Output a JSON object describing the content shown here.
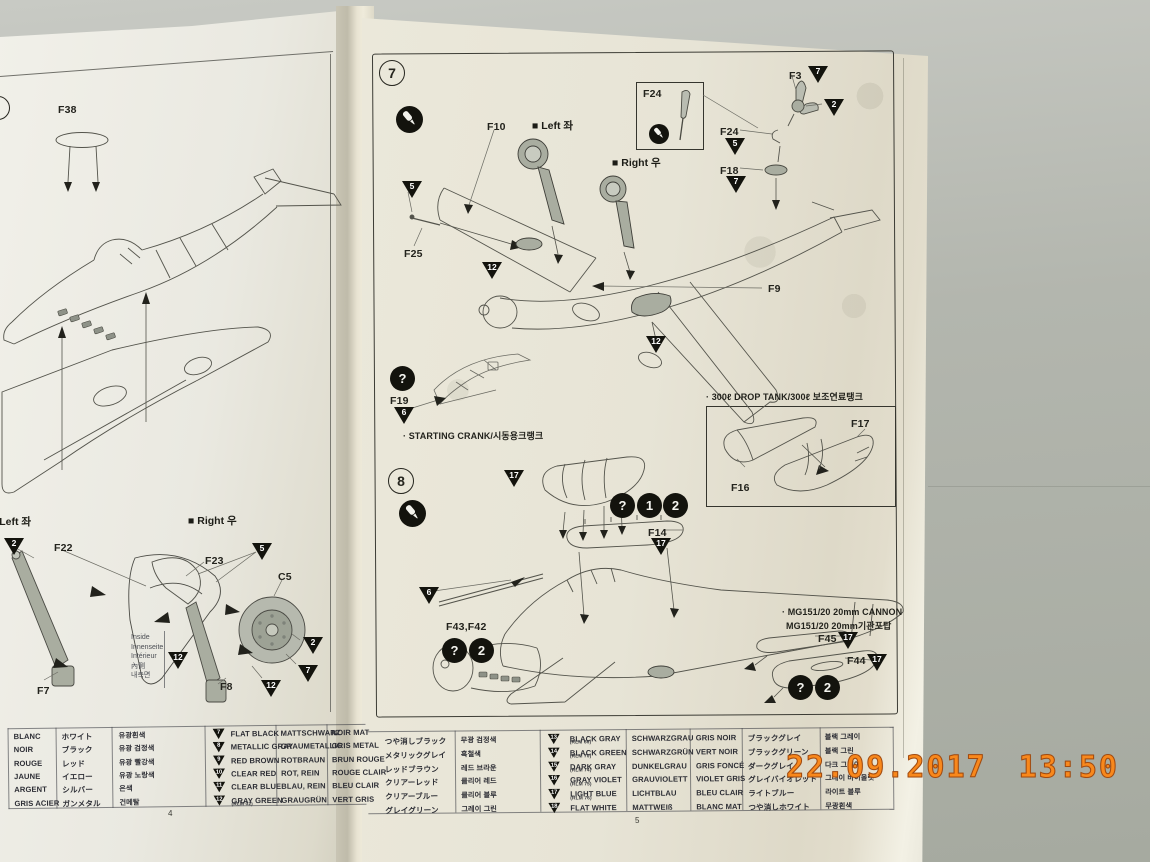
{
  "timestamp": "22.09.2017 13:50",
  "left_page": {
    "page_number": "4",
    "marker_left": "■ Left 좌",
    "marker_right": "■ Right 우",
    "inside": [
      "Inside",
      "Innenseite",
      "Intérieur",
      "內側",
      "내측면"
    ],
    "part_labels": [
      {
        "text": "F38",
        "x": 58,
        "y": 104
      },
      {
        "text": "F22",
        "x": 54,
        "y": 542
      },
      {
        "text": "F23",
        "x": 205,
        "y": 555
      },
      {
        "text": "C5",
        "x": 278,
        "y": 571
      },
      {
        "text": "F7",
        "x": 37,
        "y": 685
      },
      {
        "text": "F8",
        "x": 220,
        "y": 681
      }
    ],
    "triangles": [
      {
        "n": "2",
        "x": 4,
        "y": 538
      },
      {
        "n": "5",
        "x": 252,
        "y": 543
      },
      {
        "n": "12",
        "x": 168,
        "y": 652
      },
      {
        "n": "2",
        "x": 303,
        "y": 637
      },
      {
        "n": "7",
        "x": 298,
        "y": 665
      },
      {
        "n": "12",
        "x": 261,
        "y": 680
      }
    ]
  },
  "right_page": {
    "page_number": "5",
    "step7": {
      "number": "7",
      "marker_left": "■ Left 좌",
      "marker_right": "■ Right 우",
      "note_crank": "· STARTING CRANK/시동용크랭크",
      "note_drop_tank": "· 300ℓ DROP TANK/300ℓ 보조연료탱크"
    },
    "step8": {
      "number": "8",
      "note_cannon_en": "· MG151/20 20mm CANNON",
      "note_cannon_ko": "MG151/20 20mm기관포탑"
    },
    "part_labels": [
      {
        "text": "F10",
        "x": 487,
        "y": 121
      },
      {
        "text": "F24",
        "x": 643,
        "y": 88
      },
      {
        "text": "F24",
        "x": 720,
        "y": 126
      },
      {
        "text": "F3",
        "x": 789,
        "y": 70
      },
      {
        "text": "F18",
        "x": 720,
        "y": 165
      },
      {
        "text": "F25",
        "x": 404,
        "y": 248
      },
      {
        "text": "F9",
        "x": 768,
        "y": 283
      },
      {
        "text": "F19",
        "x": 390,
        "y": 395
      },
      {
        "text": "F17",
        "x": 851,
        "y": 418
      },
      {
        "text": "F16",
        "x": 731,
        "y": 482
      },
      {
        "text": "F14",
        "x": 648,
        "y": 527
      },
      {
        "text": "F43,F42",
        "x": 446,
        "y": 621
      },
      {
        "text": "F45",
        "x": 818,
        "y": 633
      },
      {
        "text": "F44",
        "x": 847,
        "y": 655
      }
    ],
    "triangles": [
      {
        "n": "5",
        "x": 402,
        "y": 181
      },
      {
        "n": "7",
        "x": 808,
        "y": 66
      },
      {
        "n": "2",
        "x": 824,
        "y": 99
      },
      {
        "n": "5",
        "x": 725,
        "y": 138
      },
      {
        "n": "7",
        "x": 726,
        "y": 176
      },
      {
        "n": "12",
        "x": 482,
        "y": 262
      },
      {
        "n": "12",
        "x": 646,
        "y": 336
      },
      {
        "n": "6",
        "x": 394,
        "y": 407
      },
      {
        "n": "17",
        "x": 504,
        "y": 470
      },
      {
        "n": "17",
        "x": 651,
        "y": 538
      },
      {
        "n": "6",
        "x": 419,
        "y": 587
      },
      {
        "n": "17",
        "x": 838,
        "y": 632
      },
      {
        "n": "17",
        "x": 867,
        "y": 654
      }
    ],
    "icons": [
      {
        "type": "glue",
        "glyph": "",
        "x": 396,
        "y": 106,
        "s": 27
      },
      {
        "type": "glue",
        "glyph": "",
        "x": 649,
        "y": 124,
        "s": 20
      },
      {
        "type": "badge",
        "glyph": "?",
        "x": 390,
        "y": 366,
        "s": 25
      },
      {
        "type": "glue",
        "glyph": "",
        "x": 399,
        "y": 500,
        "s": 27
      },
      {
        "type": "badge",
        "glyph": "?",
        "x": 610,
        "y": 493,
        "s": 25
      },
      {
        "type": "badge",
        "glyph": "1",
        "x": 637,
        "y": 493,
        "s": 25
      },
      {
        "type": "badge",
        "glyph": "2",
        "x": 663,
        "y": 493,
        "s": 25
      },
      {
        "type": "badge",
        "glyph": "?",
        "x": 442,
        "y": 638,
        "s": 25
      },
      {
        "type": "badge",
        "glyph": "2",
        "x": 469,
        "y": 638,
        "s": 25
      },
      {
        "type": "badge",
        "glyph": "?",
        "x": 788,
        "y": 675,
        "s": 25
      },
      {
        "type": "badge",
        "glyph": "2",
        "x": 815,
        "y": 675,
        "s": 25
      }
    ]
  },
  "color_table_left": {
    "rows": [
      {
        "fr": "BLANC",
        "ja": "ホワイト",
        "ko": "유광흰색"
      },
      {
        "fr": "NOIR",
        "ja": "ブラック",
        "ko": "유광 검정색"
      },
      {
        "fr": "ROUGE",
        "ja": "レッド",
        "ko": "유광 빨강색"
      },
      {
        "fr": "JAUNE",
        "ja": "イエロー",
        "ko": "유광 노랑색"
      },
      {
        "fr": "ARGENT",
        "ja": "シルバー",
        "ko": "은색"
      },
      {
        "fr": "GRIS ACIER",
        "ja": "ガンメタル",
        "ko": "건메탈"
      }
    ]
  },
  "color_table_mid": {
    "rows": [
      {
        "num": "7",
        "en": "FLAT BLACK",
        "sub": "",
        "de": "MATTSCHWARZ",
        "fr": "NOIR MAT",
        "ja": "つや消しブラック",
        "ko": "무광 검정색"
      },
      {
        "num": "8",
        "en": "METALLIC GRAY",
        "sub": "",
        "de": "GRAUMETALLIC",
        "fr": "GRIS METAL",
        "ja": "メタリックグレイ",
        "ko": "흑철색"
      },
      {
        "num": "9",
        "en": "RED BROWN",
        "sub": "",
        "de": "ROTBRAUN",
        "fr": "BRUN ROUGE",
        "ja": "レッドブラウン",
        "ko": "레드 브라운"
      },
      {
        "num": "10",
        "en": "CLEAR RED",
        "sub": "",
        "de": "ROT, REIN",
        "fr": "ROUGE CLAIR",
        "ja": "クリアーレッド",
        "ko": "클리어 레드"
      },
      {
        "num": "11",
        "en": "CLEAR BLUE",
        "sub": "",
        "de": "BLAU, REIN",
        "fr": "BLEU CLAIR",
        "ja": "クリアーブルー",
        "ko": "클리어 블루"
      },
      {
        "num": "12",
        "en": "GRAY GREEN",
        "sub": "(RLM 02)",
        "de": "GRAUGRÜN",
        "fr": "VERT GRIS",
        "ja": "グレイグリーン",
        "ko": "그레이 그린"
      }
    ]
  },
  "color_table_right": {
    "rows": [
      {
        "num": "13",
        "en": "BLACK GRAY",
        "sub": "(RLM 66)",
        "de": "SCHWARZGRAU",
        "fr": "GRIS NOIR",
        "ja": "ブラックグレイ",
        "ko": "블랙 그레이"
      },
      {
        "num": "14",
        "en": "BLACK GREEN",
        "sub": "(RLM 70)",
        "de": "SCHWARZGRÜN",
        "fr": "VERT NOIR",
        "ja": "ブラックグリーン",
        "ko": "블랙 그린"
      },
      {
        "num": "15",
        "en": "DARK GRAY",
        "sub": "(RLM 74)",
        "de": "DUNKELGRAU",
        "fr": "GRIS FONCÉ",
        "ja": "ダークグレイ",
        "ko": "다크 그레이"
      },
      {
        "num": "16",
        "en": "GRAY VIOLET",
        "sub": "(RLM 75)",
        "de": "GRAUVIOLETT",
        "fr": "VIOLET GRIS",
        "ja": "グレイバイオレット",
        "ko": "그레이 바이올렛"
      },
      {
        "num": "17",
        "en": "LIGHT BLUE",
        "sub": "(RLM 76)",
        "de": "LICHTBLAU",
        "fr": "BLEU CLAIR",
        "ja": "ライトブルー",
        "ko": "라이트 블루"
      },
      {
        "num": "18",
        "en": "FLAT WHITE",
        "sub": "",
        "de": "MATTWEIß",
        "fr": "BLANC MAT",
        "ja": "つや消しホワイト",
        "ko": "무광흰색"
      }
    ]
  }
}
